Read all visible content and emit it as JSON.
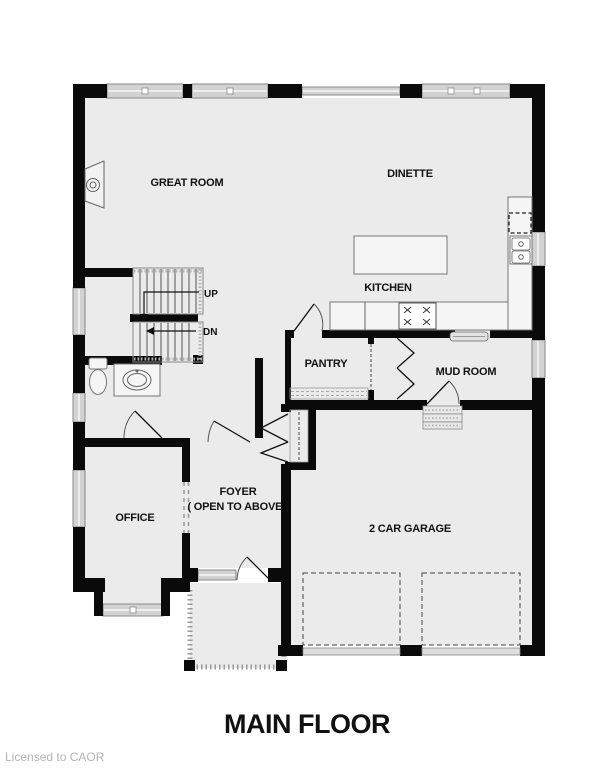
{
  "plan": {
    "title": "MAIN FLOOR",
    "license": "Licensed to CAOR",
    "labels": {
      "great_room": "GREAT ROOM",
      "dinette": "DINETTE",
      "kitchen": "KITCHEN",
      "pantry": "PANTRY",
      "mud_room": "MUD ROOM",
      "office": "OFFICE",
      "foyer": "FOYER",
      "foyer_sub": "( OPEN TO ABOVE )",
      "garage": "2 CAR GARAGE",
      "up": "UP",
      "dn": "DN"
    },
    "colors": {
      "floor": "#ebebeb",
      "wall": "#0a0a0a",
      "window": "#d2d2d2",
      "label_text": "#111111",
      "license_text": "#b5b5b5"
    }
  }
}
